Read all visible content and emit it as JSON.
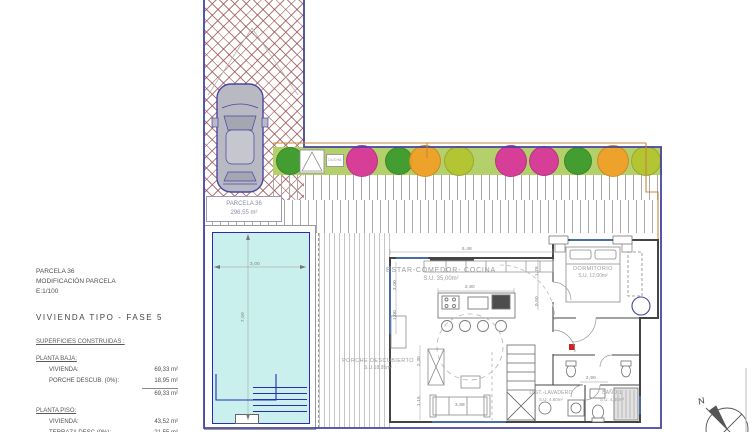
{
  "info_panel": {
    "parcel_title": "PARCELA 36",
    "subtitle": "MODIFICACIÓN PARCELA",
    "scale": "E:1/100",
    "type_title": "VIVIENDA TIPO - FASE 5",
    "surfaces_heading": "SUPERFICIES CONSTRUIDAS :",
    "planta_baja": {
      "heading": "PLANTA BAJA:",
      "rows": [
        {
          "label": "VIVIENDA:",
          "value": "69,33 m²"
        },
        {
          "label": "PORCHE DESCUB. (0%):",
          "value": "18,95 m²"
        }
      ],
      "total": "69,33 m²"
    },
    "planta_piso": {
      "heading": "PLANTA PISO:",
      "rows": [
        {
          "label": "VIVIENDA:",
          "value": "43,52 m²"
        },
        {
          "label": "TERRAZA DESC.(0%):",
          "value": "21,55 m²"
        }
      ],
      "total": "43,52 m²"
    }
  },
  "plan": {
    "parcel_label": {
      "line1": "PARCELA 36",
      "line2": "296,55 m²"
    },
    "rooms": {
      "estar": {
        "name": "ESTAR-COMEDOR- COCINA",
        "area": "S.U. 35,00m²"
      },
      "dormitorio": {
        "name": "DORMITORIO",
        "area": "S.U. 12,00m²"
      },
      "porche": {
        "name": "PORCHE DESCUBIERTO",
        "area": "S.U.18,95m²"
      },
      "lavadero": {
        "name": "DIST.-LAVADERO",
        "area": "S.U. 4,60m²"
      },
      "bano": {
        "name": "BAÑO 1",
        "area": "S.U. 4,40m²"
      },
      "ducha": {
        "name": "DUCHA"
      }
    },
    "dimensions": [
      {
        "text": "5,48"
      },
      {
        "text": "2,80"
      },
      {
        "text": "3,00"
      },
      {
        "text": "7,50"
      },
      {
        "text": "3,00"
      },
      {
        "text": "1,00"
      },
      {
        "text": "2,30"
      },
      {
        "text": "1,16"
      },
      {
        "text": "1,76"
      },
      {
        "text": "0,50"
      },
      {
        "text": "2,90"
      },
      {
        "text": "3,88"
      }
    ],
    "compass": {
      "label": "N"
    }
  },
  "palette": {
    "boundary": "#4646a0",
    "garden": "#b4d06b",
    "pool-fill": "#c9f0ec",
    "pool-border": "#2a2ab4",
    "orange-line": "#c8873c",
    "wall": "#454545",
    "glazing": "#4a7ac8",
    "car-body": "#b9b9c3",
    "label-gray": "#9b9b9b",
    "flower-green": "#3f9b2e",
    "flower-magenta": "#d8379b",
    "flower-orange": "#f0a028",
    "flower-yellowgreen": "#b3c531"
  }
}
